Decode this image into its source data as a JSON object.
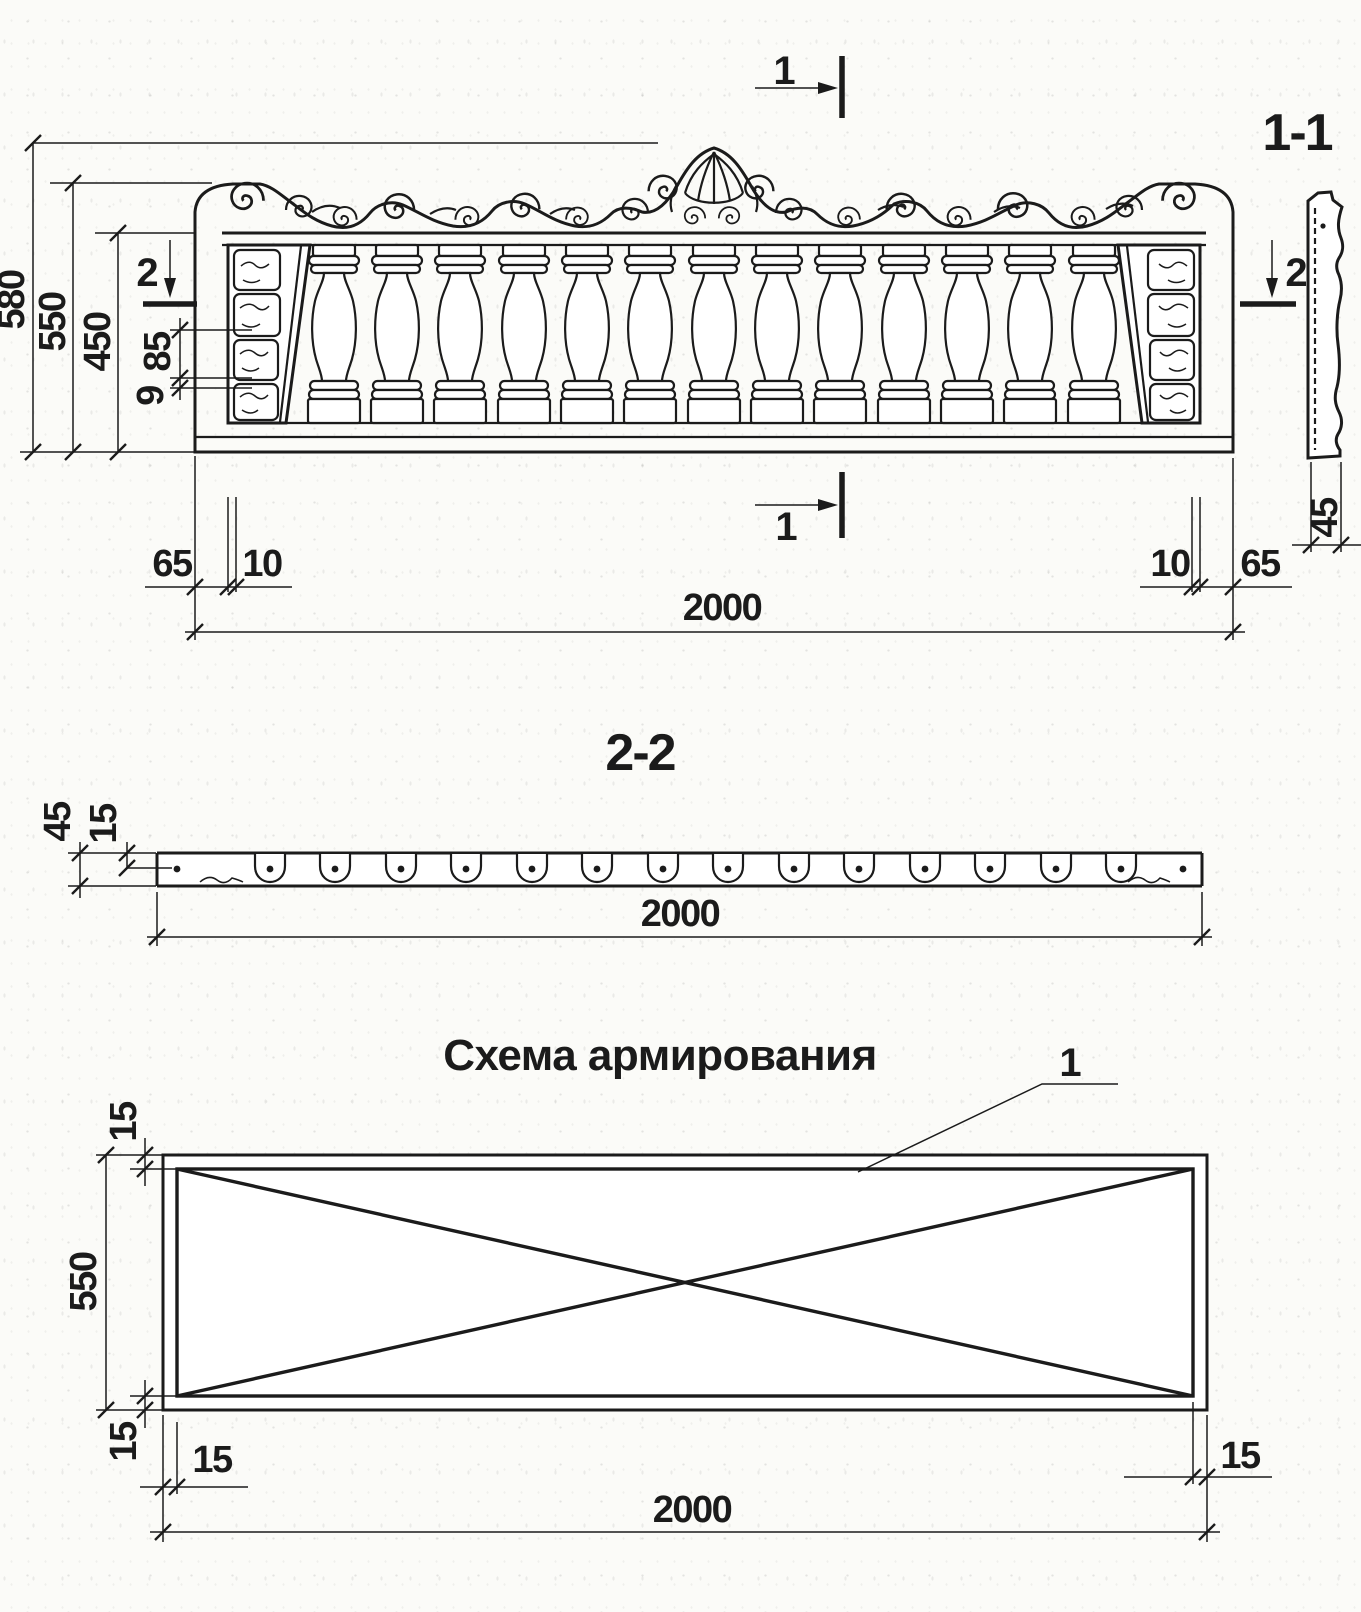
{
  "ink_color": "#1b1b1b",
  "paper_color": "#fbfbf8",
  "elevation": {
    "section_cut_1_top": "1",
    "section_cut_1_bottom": "1",
    "section_cut_2_left": "2",
    "section_cut_2_right": "2",
    "dim_overall_height": "580",
    "dim_panel_height": "550",
    "dim_baluster_field_height": "450",
    "dim_end_panel_detail": "85",
    "dim_end_panel_lip": "9",
    "dim_end_margin_left": "65",
    "dim_joint_left": "10",
    "dim_length": "2000",
    "dim_joint_right": "10",
    "dim_end_margin_right": "65"
  },
  "section_1_1": {
    "title": "1-1",
    "dim_thickness": "45"
  },
  "section_2_2": {
    "title": "2-2",
    "dim_thickness": "45",
    "dim_rebar_cover": "15",
    "dim_length": "2000"
  },
  "reinforcement": {
    "title": "Схема армирования",
    "callout_rebar": "1",
    "dim_cover_top": "15",
    "dim_height": "550",
    "dim_cover_bottom": "15",
    "dim_cover_left": "15",
    "dim_length": "2000",
    "dim_cover_right": "15"
  }
}
